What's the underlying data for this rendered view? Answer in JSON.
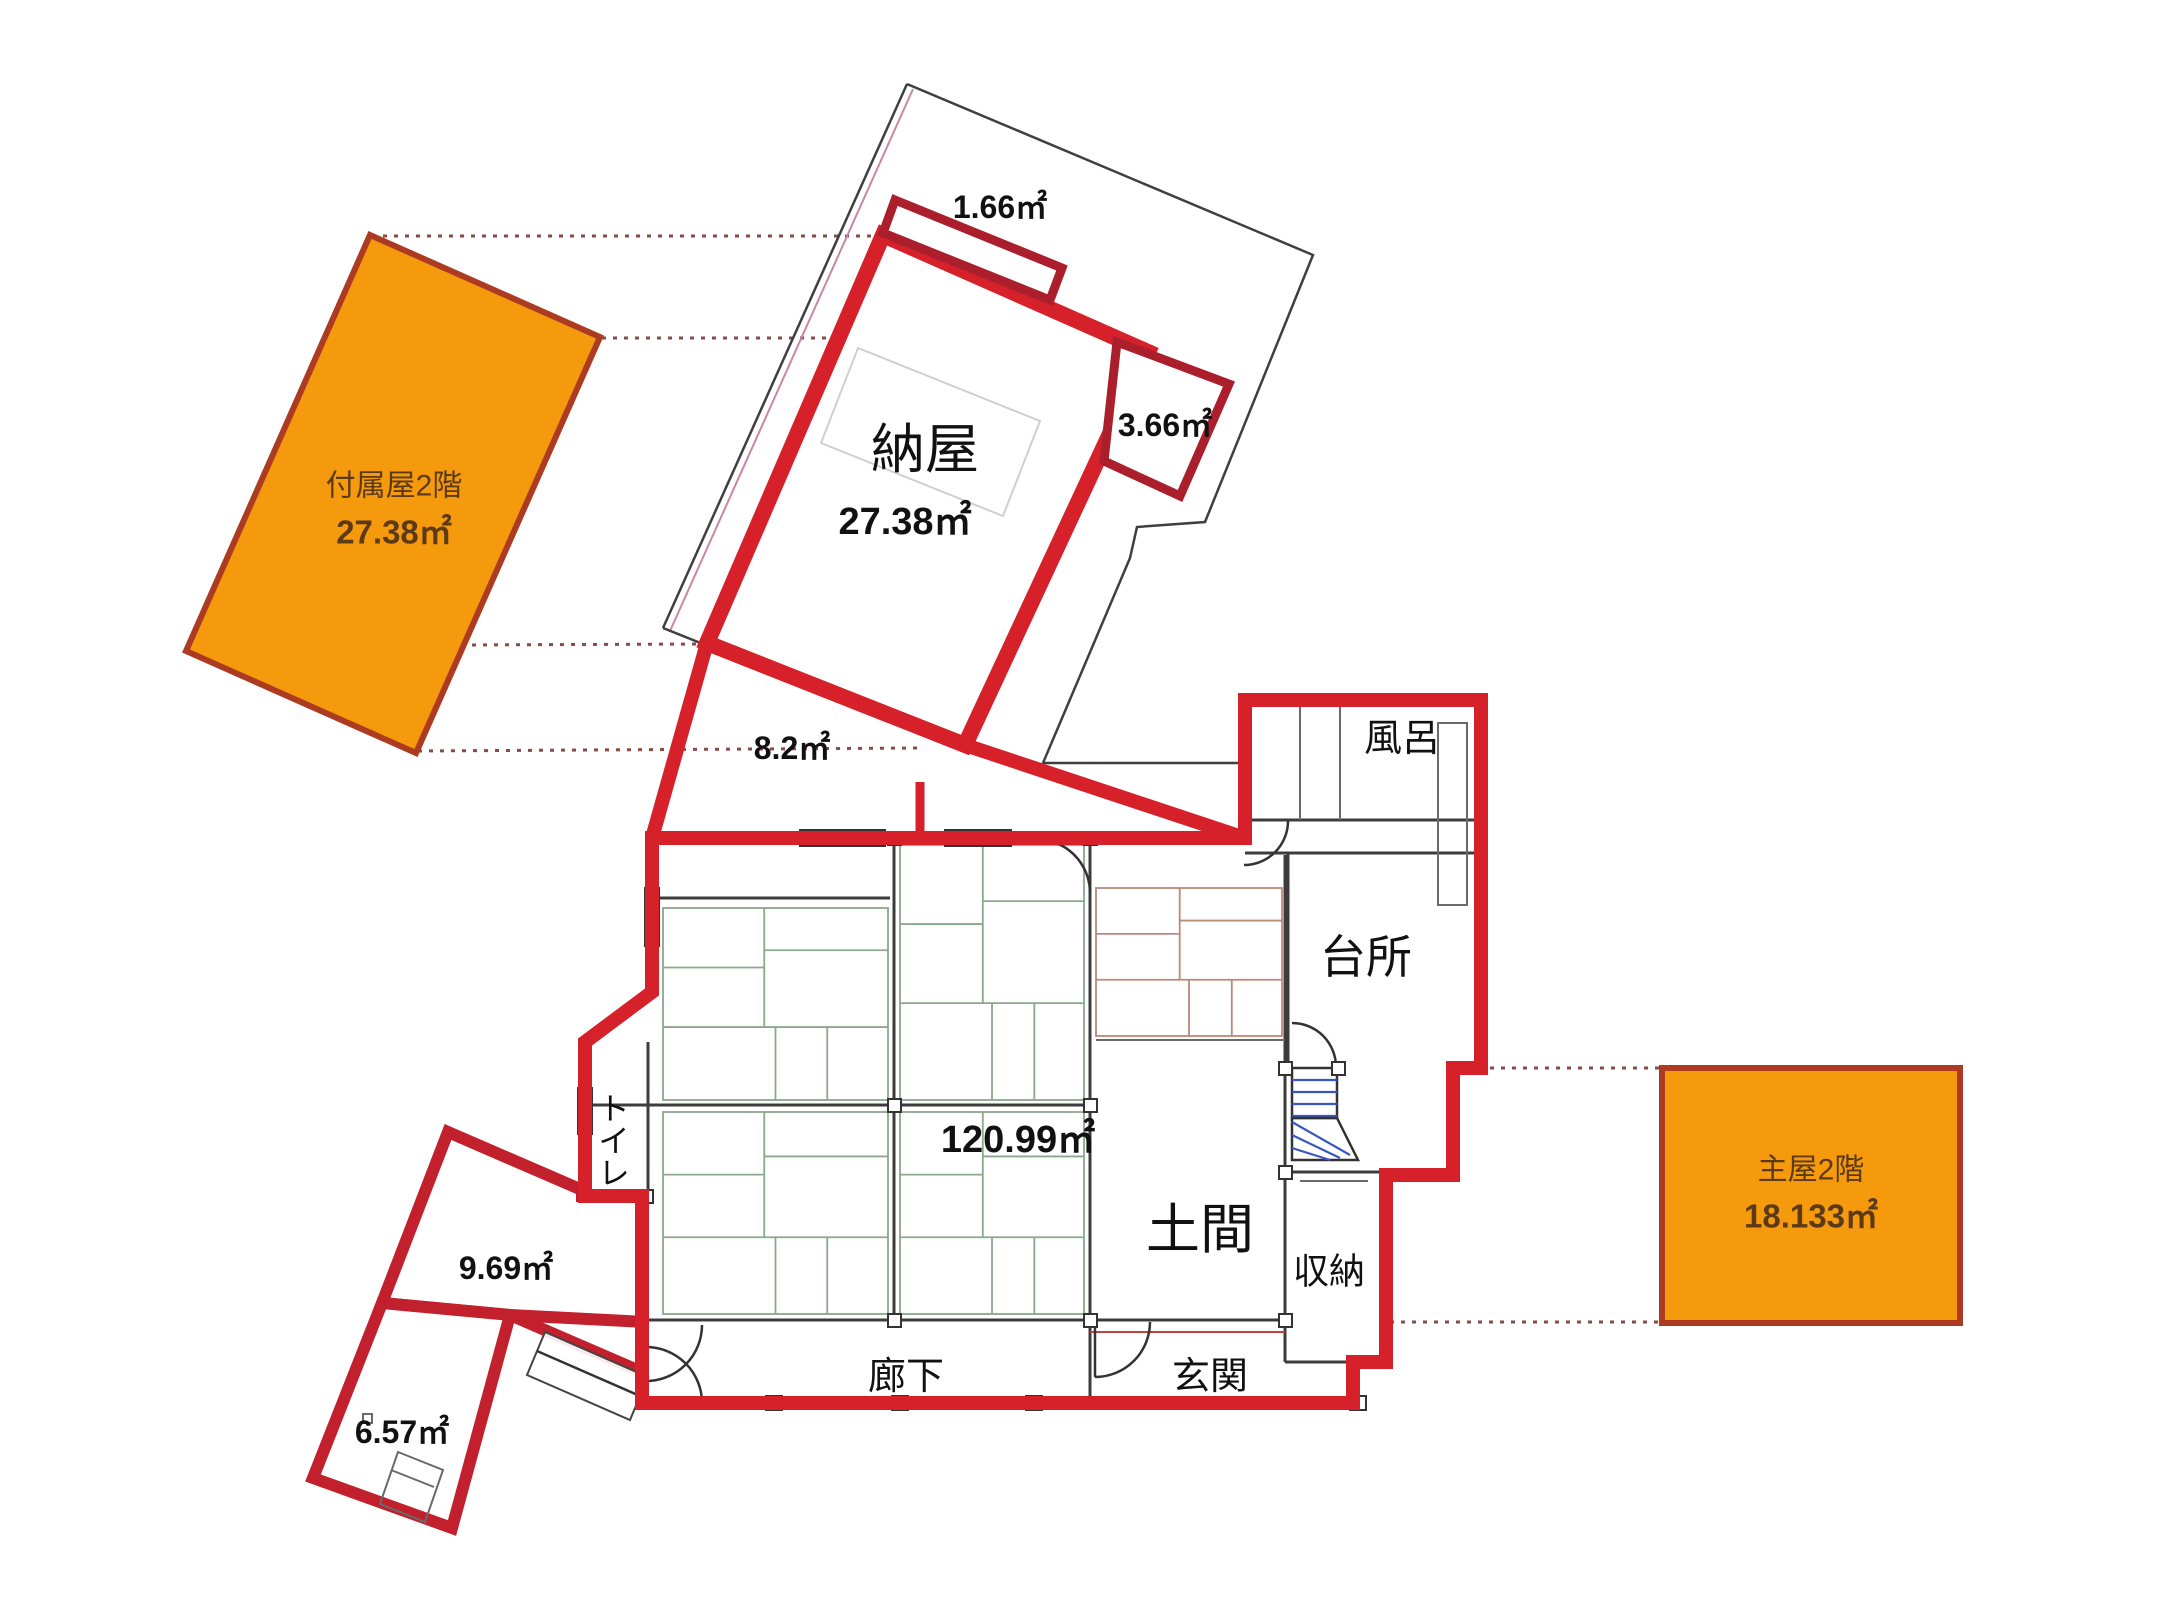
{
  "plan": {
    "attached_2f": {
      "name": "付属屋2階",
      "area": "27.38㎡"
    },
    "barn": {
      "name": "納屋",
      "area": "27.38㎡"
    },
    "annex_top": {
      "area": "1.66㎡"
    },
    "annex_right": {
      "area": "3.66㎡"
    },
    "connector": {
      "area": "8.2㎡"
    },
    "main_floor": {
      "area": "120.99㎡"
    },
    "bath": {
      "name": "風呂"
    },
    "kitchen": {
      "name": "台所"
    },
    "doma": {
      "name": "土間"
    },
    "storage": {
      "name": "収納"
    },
    "entrance": {
      "name": "玄関"
    },
    "corridor": {
      "name": "廊下"
    },
    "toilet": {
      "name": "トイレ"
    },
    "annex_left_upper": {
      "area": "9.69㎡"
    },
    "annex_left_lower": {
      "area": "6.57㎡"
    },
    "main_2f": {
      "name": "主屋2階",
      "area": "18.133㎡"
    }
  },
  "colors": {
    "c-red": "#d6212b",
    "c-darkred": "#ab1f2d",
    "c-annexred": "#c2202c",
    "c-orange": "#f5990d",
    "c-orangeborder": "#ad3b22",
    "c-tatami-g": "#8aa88a",
    "c-tatami-r": "#bc8878",
    "c-stair": "#3a57c0",
    "c-brown": "#5c3a16",
    "c-dot": "#8a4a46"
  }
}
